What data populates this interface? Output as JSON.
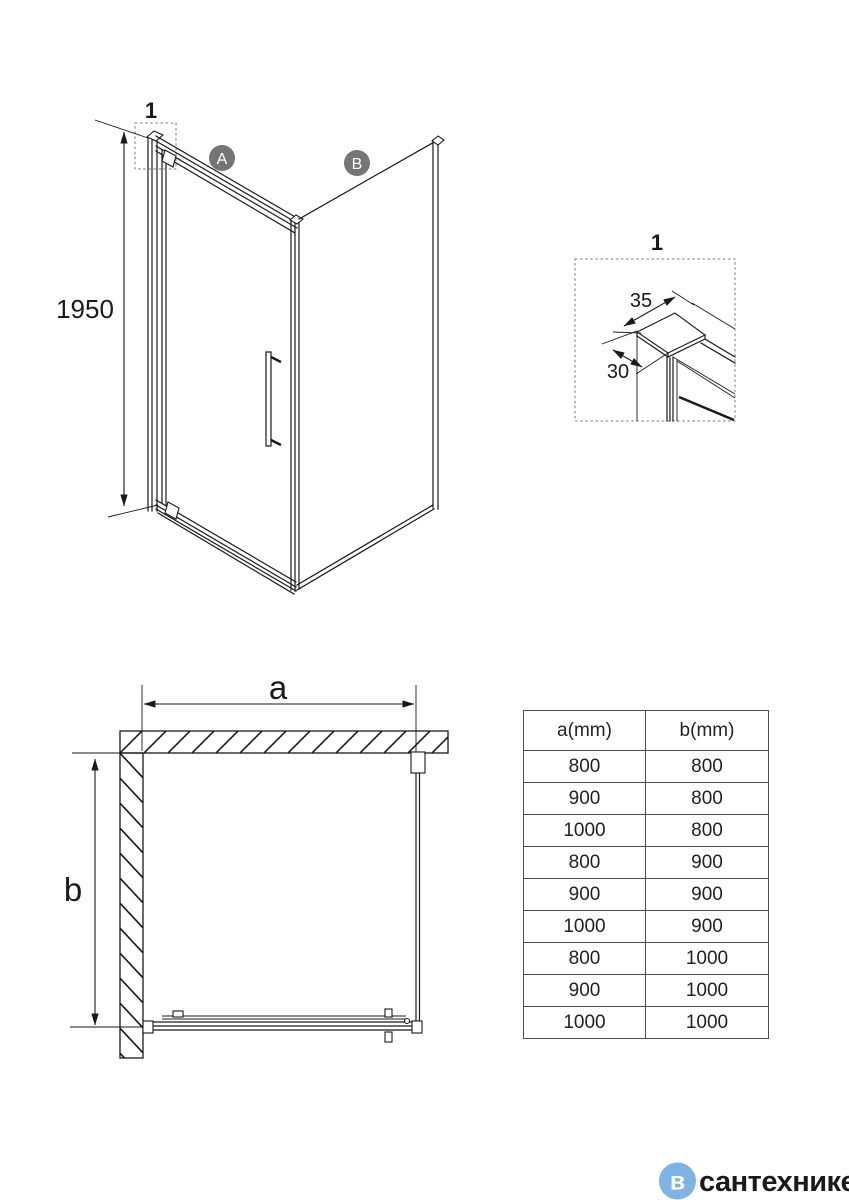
{
  "colors": {
    "badge_gray": "#757575",
    "watermark_blue": "#7FB3E1",
    "watermark_gray": "#9E9E9E"
  },
  "iso_view": {
    "detail_callout_label": "1",
    "height_dimension": "1950",
    "panel_a_label": "A",
    "panel_b_label": "B"
  },
  "detail_view": {
    "label": "1",
    "top_dimension": "35",
    "side_dimension": "30"
  },
  "plan_view": {
    "width_dimension_label": "a",
    "depth_dimension_label": "b"
  },
  "size_table": {
    "col_a_header": "a(mm)",
    "col_b_header": "b(mm)",
    "rows": [
      [
        "800",
        "800"
      ],
      [
        "900",
        "800"
      ],
      [
        "1000",
        "800"
      ],
      [
        "800",
        "900"
      ],
      [
        "900",
        "900"
      ],
      [
        "1000",
        "900"
      ],
      [
        "800",
        "1000"
      ],
      [
        "900",
        "1000"
      ],
      [
        "1000",
        "1000"
      ]
    ]
  },
  "watermark": {
    "icon_letter": "в",
    "brand_text": "сантехнике"
  }
}
